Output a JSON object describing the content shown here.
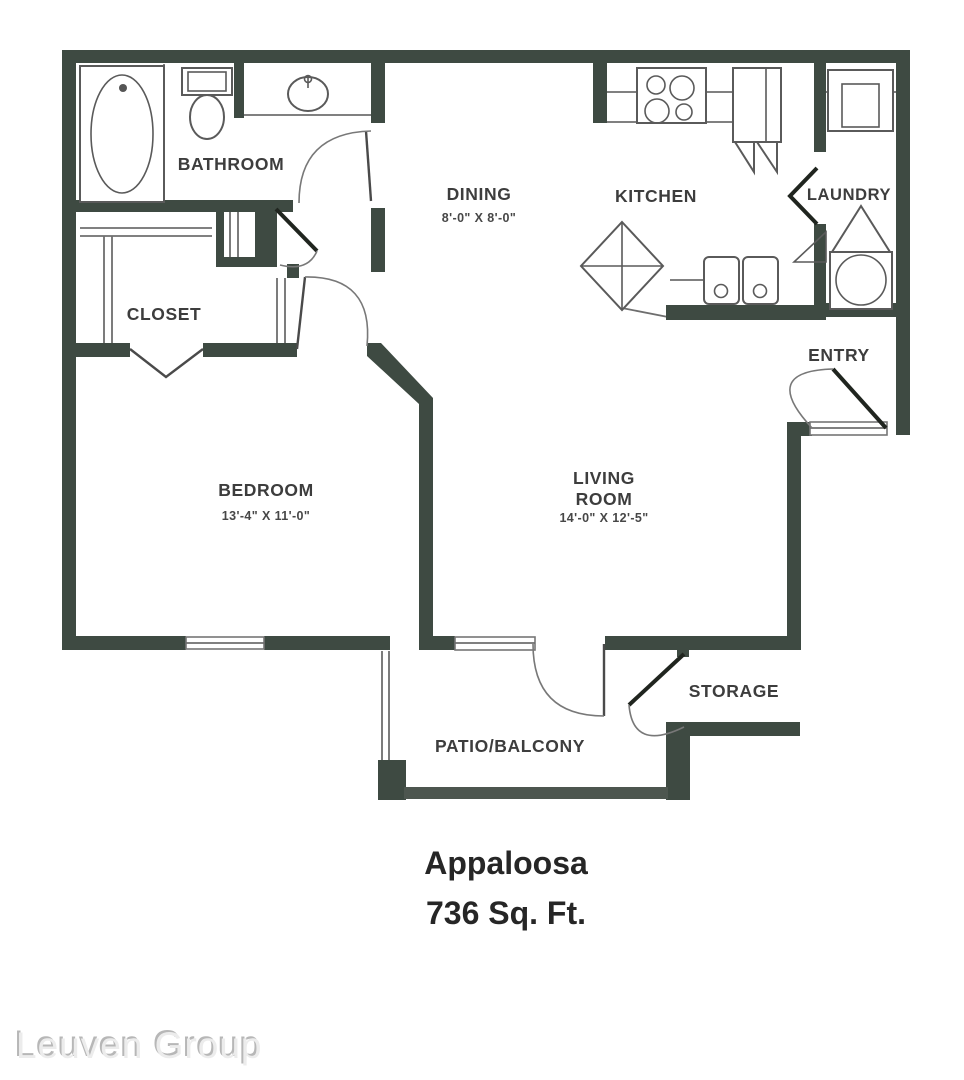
{
  "plan": {
    "title": "Appaloosa",
    "subtitle": "736 Sq. Ft.",
    "watermark": "Leuven Group",
    "colors": {
      "wall": "#3e4a42",
      "label_text": "#3d3d3d",
      "watermark_gray": "#c9c9c9"
    },
    "rooms": {
      "bathroom": {
        "label": "BATHROOM"
      },
      "closet": {
        "label": "CLOSET"
      },
      "bedroom": {
        "label": "BEDROOM",
        "dims": "13'-4\" X 11'-0\""
      },
      "dining": {
        "label": "DINING",
        "dims": "8'-0\" X 8'-0\""
      },
      "kitchen": {
        "label": "KITCHEN"
      },
      "laundry": {
        "label": "LAUNDRY"
      },
      "entry": {
        "label": "ENTRY"
      },
      "living": {
        "label_line1": "LIVING",
        "label_line2": "ROOM",
        "dims": "14'-0\" X 12'-5\""
      },
      "storage": {
        "label": "STORAGE"
      },
      "patio": {
        "label": "PATIO/BALCONY"
      }
    }
  }
}
